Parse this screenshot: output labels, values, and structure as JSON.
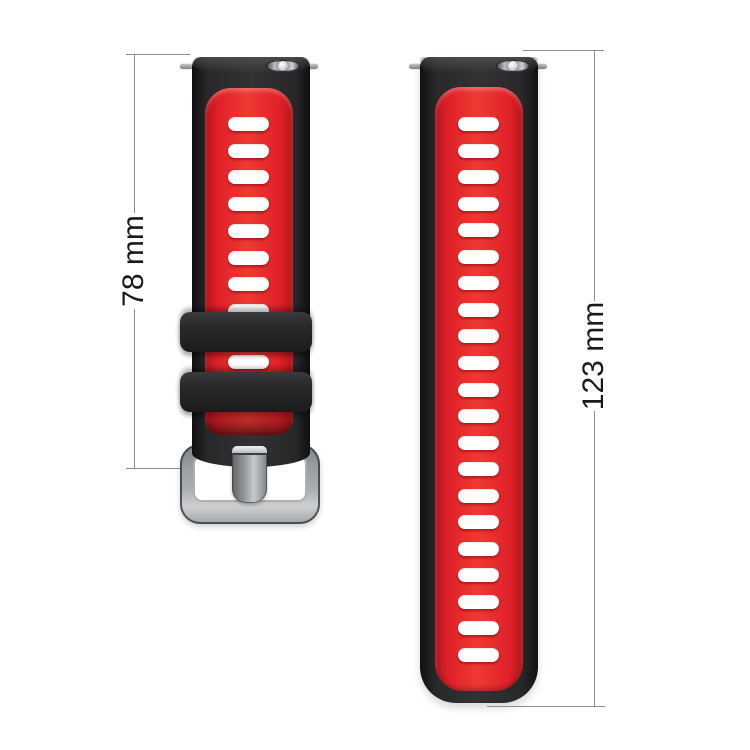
{
  "page": {
    "background": "#ffffff",
    "description": "Two-piece black/red silicone watch band shown vertically with length dimensions"
  },
  "dimensions": {
    "short_strap_label": "78 mm",
    "long_strap_label": "123 mm"
  },
  "product": {
    "short_strap": {
      "side": "buckle side",
      "visible_slots_upper": 8,
      "visible_slots_between_keepers": 1,
      "keeper_count": 2,
      "has_buckle": true,
      "has_spring_bar": true
    },
    "long_strap": {
      "side": "tongue side",
      "visible_slots": 21,
      "has_spring_bar": true
    }
  },
  "colors": {
    "band_red": "#e02129",
    "band_black": "#232325",
    "buckle_silver": "#a9acb0",
    "dimension_line": "#8c8c8c",
    "label_text": "#1a1a1a",
    "background": "#ffffff"
  }
}
